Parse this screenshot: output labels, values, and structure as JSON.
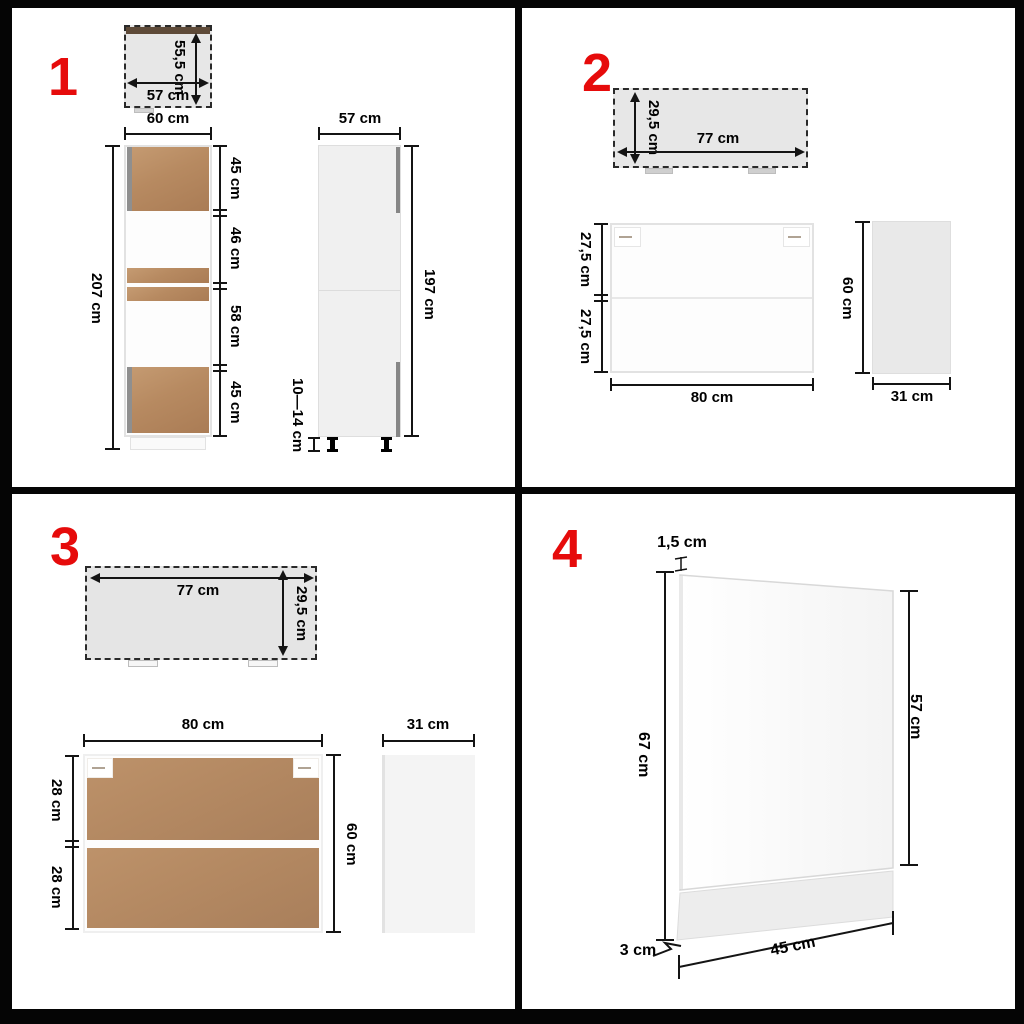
{
  "colors": {
    "accent_red": "#e60b0b",
    "wood_brown": "#b78a61",
    "wood_dark_strip": "#5e4a38",
    "topview_gray": "#e7e7e7"
  },
  "q1": {
    "num": "1",
    "top": {
      "w": "57 cm",
      "d": "55,5 cm"
    },
    "front": {
      "w": "60 cm",
      "h": "207 cm",
      "segs": [
        "45 cm",
        "46 cm",
        "58 cm",
        "45 cm"
      ]
    },
    "side": {
      "w": "57 cm",
      "h": "197 cm",
      "legs": "10—14 cm"
    }
  },
  "q2": {
    "num": "2",
    "top": {
      "d": "29,5 cm",
      "w": "77 cm"
    },
    "front": {
      "segs": [
        "27,5 cm",
        "27,5 cm"
      ],
      "w": "80 cm"
    },
    "side": {
      "h": "60 cm",
      "w": "31 cm"
    }
  },
  "q3": {
    "num": "3",
    "top": {
      "w": "77 cm",
      "d": "29,5 cm"
    },
    "front": {
      "w": "80 cm",
      "segs": [
        "28 cm",
        "28 cm"
      ],
      "h": "60 cm"
    },
    "side": {
      "w": "31 cm"
    }
  },
  "q4": {
    "num": "4",
    "thickness": "1,5 cm",
    "left_h": "67 cm",
    "right_h": "57 cm",
    "plinth": "3 cm",
    "w": "45 cm"
  }
}
